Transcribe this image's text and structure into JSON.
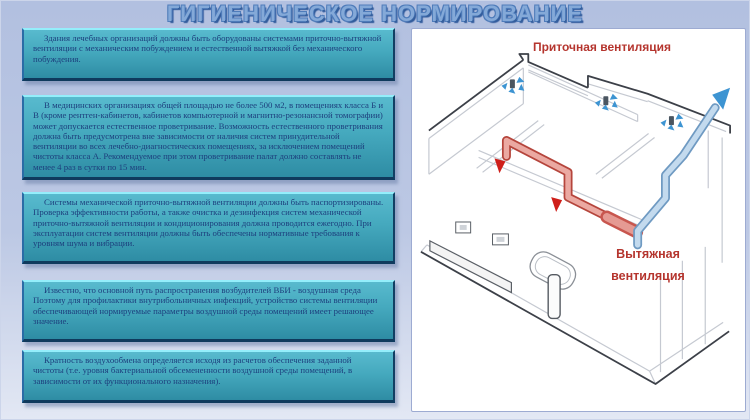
{
  "slide": {
    "title": "ГИГИЕНИЧЕСКОЕ НОРМИРОВАНИЕ"
  },
  "blocks": [
    "Здания лечебных организаций должны быть оборудованы системами приточно-вытяжной вентиляции с механическим побуждением и естественной вытяжкой без механического побуждения.",
    "В медицинских организациях общей площадью не более 500 м2, в помещениях класса Б и В (кроме рентген-кабинетов, кабинетов компьютерной и магнитно-резонансной томографии) может допускается естественное проветривание. Возможность естественного проветривания должна быть предусмотрена вне зависимости от наличия систем принудительной вентиляции во всех лечебно-диагностических помещениях, за исключением помещений чистоты класса А. Рекомендуемое при этом проветривание палат должно составлять не менее 4 раз в сутки по 15 мин.",
    "Системы механической приточно-вытяжной вентиляции должны быть паспортизированы. Проверка эффективности работы, а также очистка и дезинфекция систем механической приточно-вытяжной вентиляции и кондиционирования должна проводится ежегодно. При эксплуатации систем вентиляции должны быть обеспечены нормативные требования к уровням шума и вибрации.",
    "Известно, что основной путь распространения возбудителей ВБИ - воздушная среда Поэтому для профилактики внутрибольничных инфекций, устройство системы вентиляции обеспечивающей нормируемые параметры воздушной среды помещений имеет решающее значение.",
    "Кратность воздухообмена определяется исходя из расчетов обеспечения заданной чистоты (т.е. уровня бактериальной обсемененности воздушной среды помещений, в зависимости от их функционального назначения)."
  ],
  "diagram": {
    "supply_label": "Приточная вентиляция",
    "exhaust_label": "Вытяжная\nвентиляция"
  },
  "colors": {
    "slide_background": "#b7c4e2",
    "title_blue": "#84a9d8",
    "block_teal_top": "#58bace",
    "block_teal_bottom": "#2e8ca4",
    "block_text_navy": "#1d3f7d",
    "label_red": "#b5352e",
    "supply_duct_red": "#eba9a2",
    "exhaust_duct_blue": "#c3daee"
  }
}
